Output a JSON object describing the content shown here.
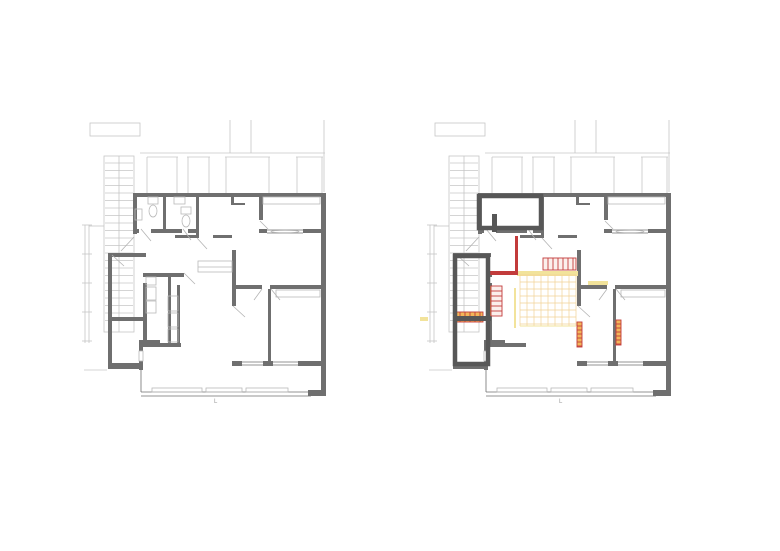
{
  "canvas": {
    "w": 780,
    "h": 551,
    "bg": "#ffffff"
  },
  "colors": {
    "wall": "#6f6f6f",
    "walld": "#575757",
    "context": "#c6c6c6",
    "fixture": "#b9b9b9",
    "door": "#b3b3b3",
    "red": "#c23b3b",
    "orange": "#efa23c",
    "yellow": "#f2e39b",
    "grid": "#f2d294",
    "ladfill": "#fbefec",
    "ladorange": "#f2b65a"
  },
  "plans": [
    {
      "name": "plan-left-existing",
      "dx": 0,
      "layers": [
        "context",
        "stairs",
        "base",
        "existing"
      ]
    },
    {
      "name": "plan-right-proposal",
      "dx": 345,
      "layers": [
        "context",
        "stairs",
        "base",
        "proposal"
      ]
    }
  ],
  "annotations": {
    "left_mark": "L",
    "right_mark": "L"
  },
  "layers": {
    "context": [
      {
        "t": "or",
        "p": [
          90,
          123,
          50,
          13
        ],
        "c": "context",
        "w": 0.8
      },
      {
        "t": "ln",
        "p": [
          230,
          120,
          230,
          153
        ],
        "c": "context",
        "w": 0.8
      },
      {
        "t": "ln",
        "p": [
          251,
          120,
          251,
          153
        ],
        "c": "context",
        "w": 0.8
      },
      {
        "t": "ln",
        "p": [
          140,
          153,
          325,
          153
        ],
        "c": "context",
        "w": 0.8
      },
      {
        "t": "ln",
        "p": [
          147,
          157,
          178,
          157
        ],
        "c": "context",
        "w": 0.8
      },
      {
        "t": "ln",
        "p": [
          187,
          157,
          210,
          157
        ],
        "c": "context",
        "w": 0.8
      },
      {
        "t": "ln",
        "p": [
          225,
          157,
          270,
          157
        ],
        "c": "context",
        "w": 0.8
      },
      {
        "t": "ln",
        "p": [
          296,
          157,
          323,
          157
        ],
        "c": "context",
        "w": 0.8
      },
      {
        "t": "ln",
        "p": [
          147,
          157,
          147,
          193
        ],
        "c": "context",
        "w": 0.8
      },
      {
        "t": "ln",
        "p": [
          177,
          157,
          177,
          193
        ],
        "c": "context",
        "w": 0.8
      },
      {
        "t": "ln",
        "p": [
          188,
          157,
          188,
          193
        ],
        "c": "context",
        "w": 0.8
      },
      {
        "t": "ln",
        "p": [
          209,
          157,
          209,
          193
        ],
        "c": "context",
        "w": 0.8
      },
      {
        "t": "ln",
        "p": [
          226,
          157,
          226,
          193
        ],
        "c": "context",
        "w": 0.8
      },
      {
        "t": "ln",
        "p": [
          269,
          157,
          269,
          193
        ],
        "c": "context",
        "w": 0.8
      },
      {
        "t": "ln",
        "p": [
          297,
          157,
          297,
          193
        ],
        "c": "context",
        "w": 0.8
      },
      {
        "t": "ln",
        "p": [
          322,
          157,
          322,
          193
        ],
        "c": "context",
        "w": 0.8
      },
      {
        "t": "ln",
        "p": [
          324,
          120,
          324,
          192
        ],
        "c": "context",
        "w": 0.8
      },
      {
        "t": "ln",
        "p": [
          85,
          225,
          85,
          343
        ],
        "c": "context",
        "w": 0.8
      },
      {
        "t": "ln",
        "p": [
          89,
          225,
          89,
          343
        ],
        "c": "context",
        "w": 0.8
      },
      {
        "t": "ln",
        "p": [
          82,
          225,
          92,
          225
        ],
        "c": "context",
        "w": 0.8
      },
      {
        "t": "ln",
        "p": [
          82,
          254,
          92,
          254
        ],
        "c": "context",
        "w": 0.8
      },
      {
        "t": "ln",
        "p": [
          82,
          283,
          92,
          283
        ],
        "c": "context",
        "w": 0.8
      },
      {
        "t": "ln",
        "p": [
          82,
          312,
          92,
          312
        ],
        "c": "context",
        "w": 0.8
      },
      {
        "t": "ln",
        "p": [
          82,
          341,
          92,
          341
        ],
        "c": "context",
        "w": 0.8
      },
      {
        "t": "ln",
        "p": [
          89,
          226,
          104,
          226
        ],
        "c": "context",
        "w": 0.8
      },
      {
        "t": "ln",
        "p": [
          84,
          370,
          107,
          370
        ],
        "c": "context",
        "w": 0.8
      }
    ],
    "stairs": [
      {
        "t": "or",
        "p": [
          104,
          156,
          30,
          176
        ],
        "c": "context",
        "w": 0.8
      },
      {
        "t": "ln",
        "p": [
          119,
          156,
          119,
          332
        ],
        "c": "context",
        "w": 0.8
      },
      {
        "t": "tr",
        "p": [
          105,
          163,
          133,
          327
        ],
        "step": 7.5,
        "c": "context"
      }
    ],
    "base": [
      {
        "t": "rc",
        "p": [
          133,
          193,
          192,
          4
        ],
        "c": "wall"
      },
      {
        "t": "rc",
        "p": [
          321,
          193,
          5,
          203
        ],
        "c": "wall"
      },
      {
        "t": "rc",
        "p": [
          133,
          193,
          4,
          41
        ],
        "c": "wall"
      },
      {
        "t": "rc",
        "p": [
          133,
          229,
          6,
          4
        ],
        "c": "wall"
      },
      {
        "t": "rc",
        "p": [
          151,
          229,
          31,
          4
        ],
        "c": "wall"
      },
      {
        "t": "rc",
        "p": [
          188,
          229,
          11,
          4
        ],
        "c": "wall"
      },
      {
        "t": "rc",
        "p": [
          196,
          196,
          3,
          42
        ],
        "c": "wall"
      },
      {
        "t": "rc",
        "p": [
          231,
          197,
          3,
          7
        ],
        "c": "wall"
      },
      {
        "t": "rc",
        "p": [
          231,
          203,
          14,
          2
        ],
        "c": "wall"
      },
      {
        "t": "rc",
        "p": [
          175,
          235,
          21,
          3
        ],
        "c": "wall"
      },
      {
        "t": "rc",
        "p": [
          213,
          235,
          19,
          3
        ],
        "c": "wall"
      },
      {
        "t": "rc",
        "p": [
          259,
          196,
          4,
          24
        ],
        "c": "wall"
      },
      {
        "t": "rc",
        "p": [
          259,
          229,
          8,
          4
        ],
        "c": "wall"
      },
      {
        "t": "rc",
        "p": [
          303,
          229,
          18,
          4
        ],
        "c": "wall"
      },
      {
        "t": "rc",
        "p": [
          232,
          250,
          4,
          56
        ],
        "c": "wall"
      },
      {
        "t": "rc",
        "p": [
          236,
          285,
          26,
          4
        ],
        "c": "wall"
      },
      {
        "t": "rc",
        "p": [
          270,
          285,
          51,
          4
        ],
        "c": "wall"
      },
      {
        "t": "rc",
        "p": [
          268,
          289,
          3,
          75
        ],
        "c": "wall"
      },
      {
        "t": "rc",
        "p": [
          232,
          361,
          10,
          5
        ],
        "c": "wall"
      },
      {
        "t": "rc",
        "p": [
          263,
          361,
          10,
          5
        ],
        "c": "wall"
      },
      {
        "t": "rc",
        "p": [
          298,
          361,
          23,
          5
        ],
        "c": "wall"
      },
      {
        "t": "rc",
        "p": [
          108,
          253,
          4,
          115
        ],
        "c": "wall"
      },
      {
        "t": "rc",
        "p": [
          108,
          253,
          38,
          4
        ],
        "c": "wall"
      },
      {
        "t": "rc",
        "p": [
          110,
          317,
          36,
          4
        ],
        "c": "wall"
      },
      {
        "t": "rc",
        "p": [
          108,
          363,
          32,
          6
        ],
        "c": "wall"
      },
      {
        "t": "rc",
        "p": [
          143,
          283,
          4,
          62
        ],
        "c": "wall"
      },
      {
        "t": "rc",
        "p": [
          143,
          273,
          4,
          4
        ],
        "c": "wall"
      },
      {
        "t": "rc",
        "p": [
          143,
          343,
          38,
          4
        ],
        "c": "wall"
      },
      {
        "t": "rc",
        "p": [
          139,
          340,
          21,
          4
        ],
        "c": "wall"
      },
      {
        "t": "rc",
        "p": [
          139,
          344,
          4,
          26
        ],
        "c": "wall"
      },
      {
        "t": "rc",
        "p": [
          308,
          390,
          17,
          6
        ],
        "c": "wall"
      },
      {
        "t": "rc",
        "p": [
          139,
          351,
          4,
          10
        ],
        "c": "#ffffff"
      },
      {
        "t": "or",
        "p": [
          139,
          351,
          4,
          10
        ],
        "c": "fixture",
        "w": 0.8
      },
      {
        "t": "ln",
        "p": [
          267,
          230,
          303,
          230
        ],
        "c": "wall",
        "w": 0.8
      },
      {
        "t": "ln",
        "p": [
          267,
          233,
          303,
          233
        ],
        "c": "wall",
        "w": 0.8
      },
      {
        "t": "el",
        "p": [
          285,
          231.5,
          14,
          1.2
        ],
        "c": "fixture"
      },
      {
        "t": "ln",
        "p": [
          242,
          362,
          263,
          362
        ],
        "c": "wall",
        "w": 0.8
      },
      {
        "t": "ln",
        "p": [
          242,
          365,
          263,
          365
        ],
        "c": "wall",
        "w": 0.8
      },
      {
        "t": "ln",
        "p": [
          273,
          362,
          298,
          362
        ],
        "c": "wall",
        "w": 0.8
      },
      {
        "t": "ln",
        "p": [
          273,
          365,
          298,
          365
        ],
        "c": "wall",
        "w": 0.8
      },
      {
        "t": "ln",
        "p": [
          141,
          370,
          141,
          392
        ],
        "c": "wall",
        "w": 0.8
      },
      {
        "t": "ln",
        "p": [
          141,
          392,
          311,
          392
        ],
        "c": "wall",
        "w": 0.8
      },
      {
        "t": "ln",
        "p": [
          141,
          396,
          311,
          396
        ],
        "c": "wall",
        "w": 0.8
      },
      {
        "t": "or",
        "p": [
          152,
          388,
          50,
          4
        ],
        "c": "fixture",
        "w": 0.8
      },
      {
        "t": "or",
        "p": [
          206,
          388,
          36,
          4
        ],
        "c": "fixture",
        "w": 0.8
      },
      {
        "t": "or",
        "p": [
          246,
          388,
          42,
          4
        ],
        "c": "fixture",
        "w": 0.8
      },
      {
        "t": "or",
        "p": [
          263,
          197,
          57,
          7
        ],
        "c": "fixture",
        "w": 0.8
      },
      {
        "t": "or",
        "p": [
          276,
          290,
          44,
          7
        ],
        "c": "fixture",
        "w": 0.8
      },
      {
        "t": "ln",
        "p": [
          141,
          229,
          151,
          241
        ],
        "c": "door",
        "w": 0.8
      },
      {
        "t": "ln",
        "p": [
          183,
          229,
          191,
          240
        ],
        "c": "door",
        "w": 0.8
      },
      {
        "t": "ln",
        "p": [
          197,
          238,
          207,
          249
        ],
        "c": "door",
        "w": 0.8
      },
      {
        "t": "ln",
        "p": [
          260,
          221,
          268,
          229
        ],
        "c": "door",
        "w": 0.8
      },
      {
        "t": "ln",
        "p": [
          233,
          306,
          245,
          317
        ],
        "c": "door",
        "w": 0.8
      },
      {
        "t": "ln",
        "p": [
          262,
          289,
          254,
          300
        ],
        "c": "door",
        "w": 0.8
      },
      {
        "t": "ln",
        "p": [
          271,
          289,
          280,
          300
        ],
        "c": "door",
        "w": 0.8
      },
      {
        "t": "ln",
        "p": [
          134,
          237,
          121,
          251
        ],
        "c": "door",
        "w": 0.8
      },
      {
        "t": "ln",
        "p": [
          112,
          255,
          124,
          266
        ],
        "c": "door",
        "w": 0.8
      }
    ],
    "existing": [
      {
        "t": "rc",
        "p": [
          143,
          273,
          41,
          4
        ],
        "c": "wall"
      },
      {
        "t": "rc",
        "p": [
          163,
          196,
          3,
          33
        ],
        "c": "wall"
      },
      {
        "t": "rc",
        "p": [
          168,
          277,
          3,
          68
        ],
        "c": "wall"
      },
      {
        "t": "rc",
        "p": [
          177,
          285,
          3,
          58
        ],
        "c": "wall"
      },
      {
        "t": "or",
        "p": [
          198,
          261,
          34,
          11
        ],
        "c": "fixture",
        "w": 0.8
      },
      {
        "t": "ln",
        "p": [
          198,
          267,
          232,
          267
        ],
        "c": "fixture",
        "w": 0.8
      },
      {
        "t": "or",
        "p": [
          148,
          197,
          10,
          7
        ],
        "c": "fixture",
        "w": 0.8
      },
      {
        "t": "el",
        "p": [
          153,
          211,
          4,
          6
        ],
        "c": "fixture"
      },
      {
        "t": "or",
        "p": [
          135,
          209,
          7,
          11
        ],
        "c": "fixture",
        "w": 0.8
      },
      {
        "t": "or",
        "p": [
          181,
          207,
          10,
          7
        ],
        "c": "fixture",
        "w": 0.8
      },
      {
        "t": "el",
        "p": [
          186,
          221,
          4,
          6
        ],
        "c": "fixture"
      },
      {
        "t": "or",
        "p": [
          174,
          197,
          11,
          7
        ],
        "c": "fixture",
        "w": 0.8
      },
      {
        "t": "or",
        "p": [
          146,
          277,
          10,
          8
        ],
        "c": "fixture",
        "w": 0.8
      },
      {
        "t": "or",
        "p": [
          146,
          287,
          10,
          13
        ],
        "c": "fixture",
        "w": 0.8
      },
      {
        "t": "or",
        "p": [
          146,
          301,
          10,
          12
        ],
        "c": "fixture",
        "w": 0.8
      },
      {
        "t": "or",
        "p": [
          168,
          296,
          10,
          15
        ],
        "c": "fixture",
        "w": 0.8
      },
      {
        "t": "or",
        "p": [
          168,
          313,
          10,
          14
        ],
        "c": "fixture",
        "w": 0.8
      },
      {
        "t": "or",
        "p": [
          168,
          329,
          10,
          13
        ],
        "c": "fixture",
        "w": 0.8
      },
      {
        "t": "ln",
        "p": [
          184,
          273,
          195,
          284
        ],
        "c": "door",
        "w": 0.8
      }
    ],
    "proposal": [
      {
        "t": "rc",
        "p": [
          172,
          271,
          61,
          5
        ],
        "c": "yellow"
      },
      {
        "t": "rc",
        "p": [
          243,
          281,
          20,
          4
        ],
        "c": "yellow"
      },
      {
        "t": "rc",
        "p": [
          169,
          288,
          2,
          40
        ],
        "c": "yellow"
      },
      {
        "t": "rc",
        "p": [
          75,
          317,
          8,
          4
        ],
        "c": "yellow"
      },
      {
        "t": "grd",
        "p": [
          175,
          275,
          56,
          51
        ],
        "step": 7,
        "c": "grid"
      },
      {
        "t": "ln",
        "p": [
          175,
          326,
          231,
          326
        ],
        "c": "yellow",
        "w": 1
      },
      {
        "t": "rc",
        "p": [
          170,
          236,
          3,
          37
        ],
        "c": "red"
      },
      {
        "t": "rc",
        "p": [
          142,
          271,
          31,
          4
        ],
        "c": "red"
      },
      {
        "t": "lad",
        "p": [
          198,
          258,
          33,
          12
        ],
        "dir": "v",
        "step": 5,
        "sc": "red",
        "fc": "ladfill"
      },
      {
        "t": "rc",
        "p": [
          142,
          286,
          4,
          30
        ],
        "c": "orange"
      },
      {
        "t": "lad",
        "p": [
          146,
          286,
          11,
          30
        ],
        "dir": "h",
        "step": 5,
        "sc": "red",
        "fc": "ladfill"
      },
      {
        "t": "lad",
        "p": [
          110,
          312,
          28,
          10
        ],
        "dir": "v",
        "step": 5,
        "sc": "red",
        "fc": "ladorange"
      },
      {
        "t": "lad",
        "p": [
          232,
          322,
          5,
          25
        ],
        "dir": "h",
        "step": 4,
        "sc": "red",
        "fc": "ladorange"
      },
      {
        "t": "lad",
        "p": [
          271,
          320,
          5,
          25
        ],
        "dir": "h",
        "step": 4,
        "sc": "red",
        "fc": "ladorange"
      },
      {
        "t": "or",
        "p": [
          134,
          196,
          62,
          32
        ],
        "c": "walld",
        "w": 4.5
      },
      {
        "t": "or",
        "p": [
          110,
          256,
          33,
          108
        ],
        "c": "walld",
        "w": 4.5
      },
      {
        "t": "rc",
        "p": [
          108,
          316,
          38,
          5
        ],
        "c": "walld"
      },
      {
        "t": "rc",
        "p": [
          147,
          214,
          5,
          18
        ],
        "c": "walld"
      }
    ]
  }
}
